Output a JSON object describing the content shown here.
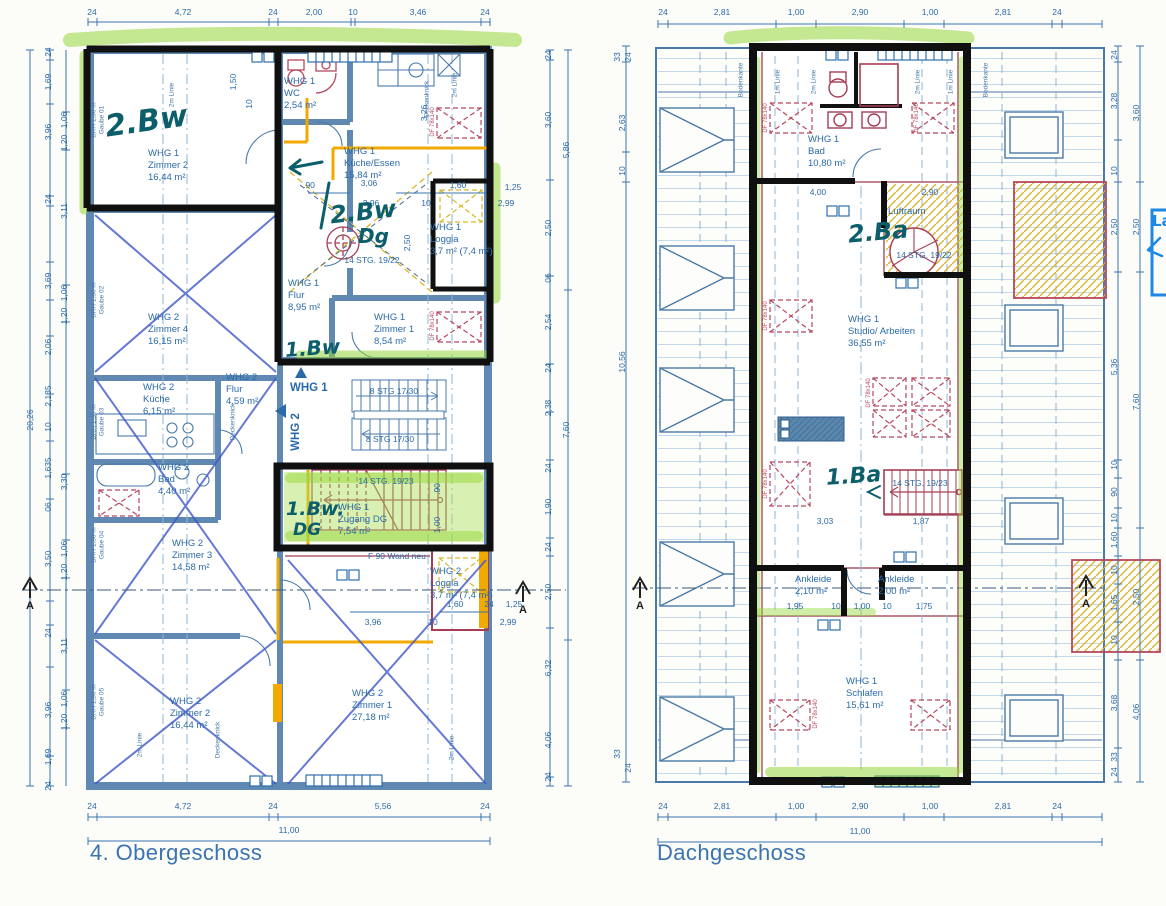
{
  "titles": {
    "left": "4. Obergeschoss",
    "right": "Dachgeschoss"
  },
  "section_marker": "A",
  "left_plan": {
    "rooms": [
      {
        "whg": "WHG 1",
        "name": "Zimmer 2",
        "area": "16,44 m²"
      },
      {
        "whg": "WHG 1",
        "name": "WC",
        "area": "2,54 m²"
      },
      {
        "whg": "WHG 1",
        "name": "Küche/Essen",
        "area": "15,84 m²"
      },
      {
        "whg": "WHG 1",
        "name": "Loggia",
        "area": "3,7 m² (7,4 m²)"
      },
      {
        "whg": "WHG 1",
        "name": "Flur",
        "area": "8,95 m²"
      },
      {
        "whg": "WHG 1",
        "name": "Zimmer 1",
        "area": "8,54 m²"
      },
      {
        "whg": "WHG 2",
        "name": "Zimmer 4",
        "area": "16,15 m²"
      },
      {
        "whg": "WHG 2",
        "name": "Küche",
        "area": "6,15 m²"
      },
      {
        "whg": "WHG 2",
        "name": "Flur",
        "area": "4,59 m²"
      },
      {
        "whg": "WHG 2",
        "name": "Bad",
        "area": "4,40 m²"
      },
      {
        "whg": "WHG 2",
        "name": "Zimmer 3",
        "area": "14,58 m²"
      },
      {
        "whg": "WHG 1",
        "name": "Zugang DG",
        "area": "7,54 m²"
      },
      {
        "whg": "WHG 2",
        "name": "Loggia",
        "area": "3,7 m² (7,4 m²)"
      },
      {
        "whg": "WHG 2",
        "name": "Zimmer 2",
        "area": "16,44 m²"
      },
      {
        "whg": "WHG 2",
        "name": "Zimmer 1",
        "area": "27,18 m²"
      }
    ],
    "units": {
      "whg1": "WHG 1",
      "whg2": "WHG 2"
    },
    "stair_labels": [
      "14 STG. 19/22",
      "8 STG 17/30",
      "8 STG 17/30",
      "14 STG. 19/23"
    ],
    "note_f90": "F 90 Wand neu",
    "pen": [
      "2.Bw",
      "2.Bw",
      "Dg",
      "1.Bw",
      "1.Bw.",
      "DG"
    ],
    "side": {
      "brh": "BRH 1,30 m",
      "gauben": [
        "Gaube 01",
        "Gaube 02",
        "Gaube 03",
        "Gaube 04",
        "Gaube 05"
      ],
      "linie2": "2m Linie",
      "deckenknick": "Deckenknick",
      "df": "DF 78x140"
    },
    "dims": {
      "top": [
        "24",
        "4,72",
        "24",
        "2,00",
        "10",
        "3,46",
        "24"
      ],
      "bottom": [
        "24",
        "4,72",
        "24",
        "5,56",
        "24"
      ],
      "bottom_total": "11,00",
      "left_total": "20,26",
      "left_a": [
        "24",
        "1,69",
        "3,96",
        "24",
        "3,69",
        "2,06",
        "2,135",
        "10",
        "1,635",
        "06",
        "3,50",
        "24",
        "3,96",
        "1,69",
        "24"
      ],
      "left_b": [
        "1,06",
        "1,20",
        "3,11",
        "1,06",
        "1,20",
        "3,30",
        "1,06",
        "1,20",
        "3,11",
        "1,06",
        "1,20"
      ],
      "right_a": [
        "24",
        "3,60",
        "2,50",
        "06",
        "2,54",
        "24",
        "2,38",
        "24",
        "1,90",
        "24",
        "2,50",
        "6,32",
        "4,06",
        "24"
      ],
      "right_b": [
        "5,86",
        "7,60"
      ],
      "inner_top": [
        ".90",
        "3,06",
        "1,60",
        "1,25",
        "3,96",
        "10",
        "2,99"
      ],
      "inner_rot": [
        "1,50",
        "10",
        "3,26",
        "2,50",
        ".90",
        "1,00"
      ],
      "inner_bottom": [
        "1,60",
        "24",
        "1,25",
        "3,96",
        "10",
        "2,99"
      ]
    }
  },
  "right_plan": {
    "rooms": [
      {
        "whg": "WHG 1",
        "name": "Bad",
        "area": "10,80 m²"
      },
      {
        "whg": "",
        "name": "Luftraum",
        "area": ""
      },
      {
        "whg": "WHG 1",
        "name": "Studio/ Arbeiten",
        "area": "36,55 m²"
      },
      {
        "whg": "",
        "name": "Ankleide",
        "area": "2,10 m²"
      },
      {
        "whg": "",
        "name": "Ankleide",
        "area": "2,00 m²"
      },
      {
        "whg": "WHG 1",
        "name": "Schlafen",
        "area": "15,61 m²"
      }
    ],
    "stair_labels": [
      "14 STG. 19/22",
      "14 STG. 19/23"
    ],
    "pen": [
      "2.Ba",
      "1.Ba"
    ],
    "blue_note": "La",
    "side": {
      "bodenkante": "Bodenkante",
      "linie1": "1m Linie",
      "linie2": "2m Linie",
      "df": "DF 78x140"
    },
    "dims": {
      "top": [
        "24",
        "2,81",
        "1,00",
        "2,90",
        "1,00",
        "2,81",
        "24"
      ],
      "bottom": [
        "24",
        "2,81",
        "1,00",
        "2,90",
        "1,00",
        "2,81",
        "24"
      ],
      "bottom_total": "11,00",
      "left_col": [
        "33",
        "24",
        "2,63",
        "10",
        "10,56",
        "24",
        "33"
      ],
      "right_a": [
        "24",
        "3,28",
        "10",
        "2,50",
        "5,36",
        "10",
        "90",
        "10",
        "1,60",
        "10",
        "1,65",
        "10",
        "3,68",
        "33",
        "24"
      ],
      "right_b": [
        "3,60",
        "2,50",
        "7,60",
        "2,50",
        "4,06"
      ],
      "inner": [
        "4,00",
        "2,90",
        "3,03",
        "1,87",
        "1,95",
        "10",
        "1,00",
        "10",
        "1,75"
      ]
    }
  }
}
